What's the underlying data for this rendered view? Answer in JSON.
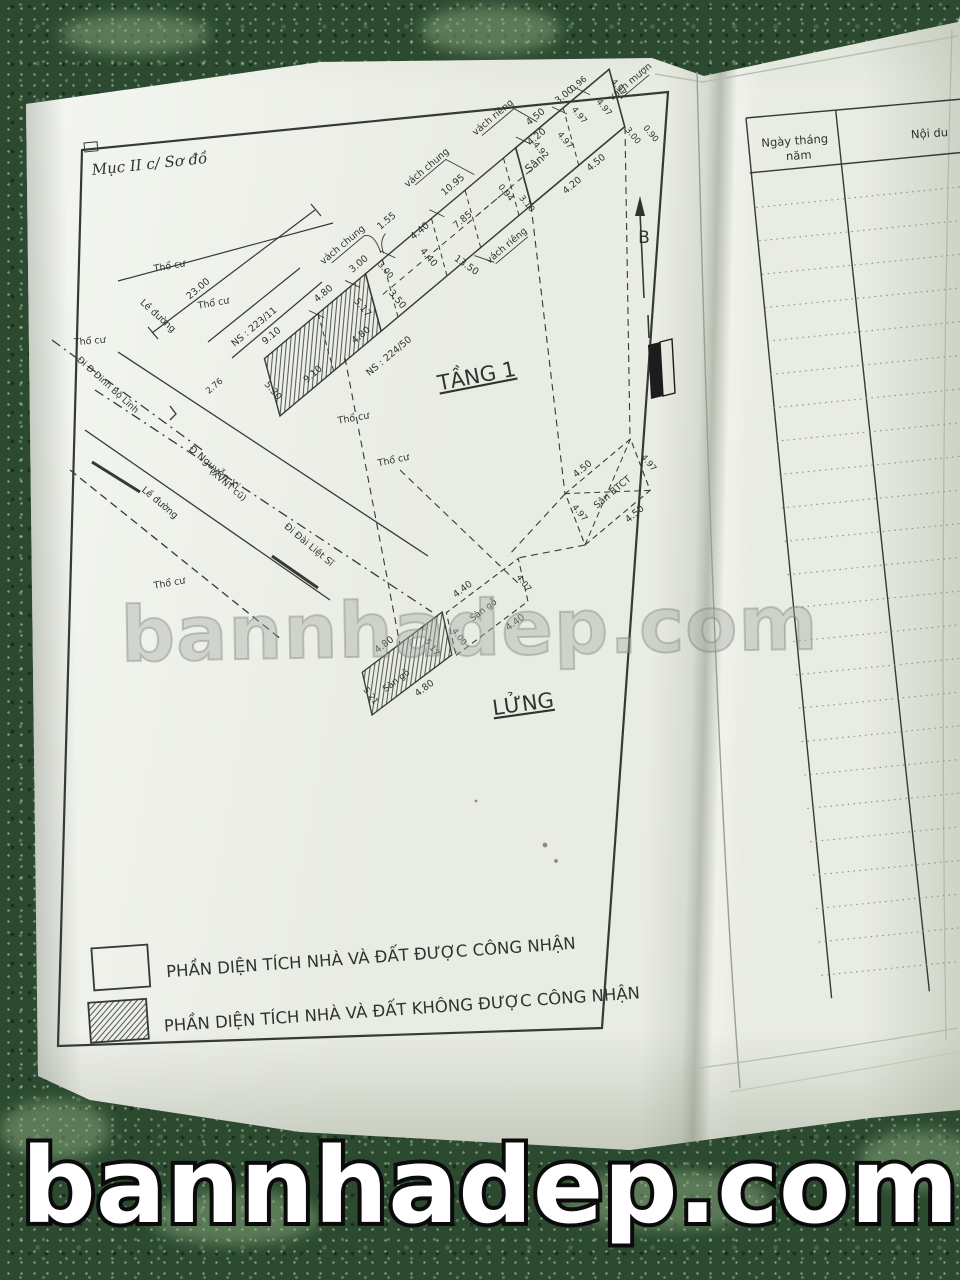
{
  "page_title": "Mục II c/ Sơ đồ",
  "watermark": {
    "middle": "bannhadep.com",
    "bottom": "bannhadep.com"
  },
  "legend": {
    "items": [
      {
        "swatch": "plain",
        "label": "PHẦN DIỆN TÍCH NHÀ VÀ ĐẤT ĐƯỢC CÔNG NHẬN"
      },
      {
        "swatch": "hatched",
        "label": "PHẦN DIỆN TÍCH NHÀ VÀ ĐẤT KHÔNG ĐƯỢC CÔNG NHẬN"
      }
    ]
  },
  "right_page": {
    "header": {
      "col1_lines": [
        "Ngày tháng",
        "năm"
      ],
      "col2": "Nội du"
    },
    "rows": 24
  },
  "colors": {
    "paper": "#e9ece3",
    "floor": "#2b4a30",
    "ink": "#343a34"
  },
  "plan": {
    "floor1_name": "TẦNG 1",
    "mezzanine_name": "LỬNG",
    "north_label": "B",
    "labels": [
      {
        "t": "TẦNG 1",
        "x": 478,
        "y": 383,
        "r": -11,
        "s": 21,
        "u": 1,
        "n": "floor-1-label"
      },
      {
        "t": "LỬNG",
        "x": 524,
        "y": 711,
        "r": -8,
        "s": 21,
        "u": 1,
        "n": "mezzanine-label"
      },
      {
        "t": "23.00",
        "x": 200,
        "y": 291,
        "r": -40,
        "n": "dim-23-00"
      },
      {
        "t": "NS : 223/11",
        "x": 256,
        "y": 329,
        "r": -40,
        "n": "house-number-223-11"
      },
      {
        "t": "2.76",
        "x": 216,
        "y": 388,
        "r": -40,
        "s": 8.5
      },
      {
        "t": "Thổ cư",
        "x": 170,
        "y": 269,
        "r": -10,
        "n": "tho-cu-label"
      },
      {
        "t": "Thổ cư",
        "x": 214,
        "y": 306,
        "r": -10,
        "n": "tho-cu-label"
      },
      {
        "t": "Thổ cư",
        "x": 90,
        "y": 344,
        "r": -5,
        "n": "tho-cu-label"
      },
      {
        "t": "Thổ cư",
        "x": 170,
        "y": 586,
        "r": -10,
        "n": "tho-cu-label"
      },
      {
        "t": "Thổ cư",
        "x": 354,
        "y": 421,
        "r": -10,
        "n": "tho-cu-label"
      },
      {
        "t": "Thổ cư",
        "x": 394,
        "y": 463,
        "r": -12,
        "n": "tho-cu-label"
      },
      {
        "t": "Lề đường",
        "x": 156,
        "y": 318,
        "r": 42,
        "n": "sidewalk-label"
      },
      {
        "t": "Lề đường",
        "x": 158,
        "y": 505,
        "r": 40,
        "n": "sidewalk-label"
      },
      {
        "t": "Đi Đ Đinh Bộ Lĩnh",
        "x": 106,
        "y": 387,
        "r": 42,
        "s": 9,
        "n": "street-dinh-bo-linh"
      },
      {
        "t": "Đ Nguyễn Xí",
        "x": 212,
        "y": 470,
        "r": 40,
        "s": 10,
        "n": "street-nguyen-xi"
      },
      {
        "t": "(XVNT cũ)",
        "x": 226,
        "y": 487,
        "r": 40,
        "s": 9,
        "n": "street-nguyen-xi-old"
      },
      {
        "t": "Đi Đài Liệt Sĩ",
        "x": 307,
        "y": 547,
        "r": 40,
        "s": 9.5,
        "n": "street-dai-liet-si"
      },
      {
        "t": "B",
        "x": 644,
        "y": 243,
        "s": 17,
        "n": "north-label"
      },
      {
        "g": "strip",
        "t": "9.10",
        "x": 45,
        "y": -64
      },
      {
        "g": "strip",
        "t": "4.80",
        "x": 112,
        "y": -63
      },
      {
        "g": "strip",
        "t": "3.00",
        "x": 158,
        "y": -63
      },
      {
        "g": "strip",
        "t": "1.55",
        "x": 207,
        "y": -78
      },
      {
        "g": "strip",
        "t": "4.40",
        "x": 226,
        "y": -49
      },
      {
        "g": "strip",
        "t": "4.40",
        "x": 213,
        "y": -26,
        "r": 90
      },
      {
        "g": "strip",
        "t": "3.00",
        "x": 172,
        "y": -44,
        "r": 90,
        "s": 8.5
      },
      {
        "g": "strip",
        "t": "10.95",
        "x": 281,
        "y": -63
      },
      {
        "g": "strip",
        "t": "5.30",
        "x": 8,
        "y": -24,
        "r": 90
      },
      {
        "g": "strip",
        "t": "9.10",
        "x": 52,
        "y": -8
      },
      {
        "g": "strip",
        "t": "4.80",
        "x": 114,
        "y": -7
      },
      {
        "g": "strip",
        "t": "5.17",
        "x": 130,
        "y": -30,
        "r": 90
      },
      {
        "g": "strip",
        "t": "3.50",
        "x": 162,
        "y": -14,
        "r": 90
      },
      {
        "g": "strip",
        "t": "7.85",
        "x": 266,
        "y": -30
      },
      {
        "g": "strip",
        "t": "13.50",
        "x": 237,
        "y": 5,
        "r": 75
      },
      {
        "g": "strip",
        "t": "0.94",
        "x": 314,
        "y": -26,
        "r": 90,
        "s": 8.5
      },
      {
        "g": "strip",
        "t": "3.10",
        "x": 323,
        "y": -4,
        "r": 90,
        "s": 8.5
      },
      {
        "g": "strip",
        "t": "NS : 224/50",
        "x": 122,
        "y": 27,
        "n": "house-number-224-50"
      },
      {
        "g": "strip",
        "t": "vách chung",
        "x": 158,
        "y": -88,
        "n": "wall-label-chung"
      },
      {
        "g": "strip",
        "t": "vách chung",
        "x": 272,
        "y": -93,
        "n": "wall-label-chung"
      },
      {
        "g": "strip",
        "t": "vách riêng",
        "x": 355,
        "y": -89,
        "n": "wall-label-rieng"
      },
      {
        "g": "strip",
        "t": "vách riêng",
        "x": 283,
        "y": 18,
        "n": "wall-label-rieng"
      },
      {
        "g": "strip",
        "t": "vách mượn",
        "x": 483,
        "y": -28,
        "n": "wall-label-muon"
      },
      {
        "g": "strip",
        "t": "Sân",
        "x": 357,
        "y": -26,
        "s": 11,
        "n": "yard-label"
      },
      {
        "g": "strip",
        "t": "4.20",
        "x": 376,
        "y": -46
      },
      {
        "g": "strip",
        "t": "4.50",
        "x": 388,
        "y": -62
      },
      {
        "g": "strip",
        "t": "3.00",
        "x": 424,
        "y": -60
      },
      {
        "g": "strip",
        "t": "0.96",
        "x": 442,
        "y": -60,
        "s": 8.5
      },
      {
        "g": "strip",
        "t": "4.92",
        "x": 368,
        "y": -36,
        "r": 90,
        "s": 8.5
      },
      {
        "g": "strip",
        "t": "4.97",
        "x": 393,
        "y": -28,
        "r": 90,
        "s": 8.5
      },
      {
        "g": "strip",
        "t": "4.97",
        "x": 420,
        "y": -38,
        "r": 90,
        "s": 8.5
      },
      {
        "g": "strip",
        "t": "4.97",
        "x": 444,
        "y": -28,
        "r": 90,
        "s": 8.5
      },
      {
        "g": "strip",
        "t": "4.97",
        "x": 468,
        "y": -34,
        "r": 90,
        "s": 8.5
      },
      {
        "g": "strip",
        "t": "4.20",
        "x": 372,
        "y": 14
      },
      {
        "g": "strip",
        "t": "4.50",
        "x": 405,
        "y": 12
      },
      {
        "g": "strip",
        "t": "3.00",
        "x": 448,
        "y": 12,
        "r": 90,
        "s": 8.5
      },
      {
        "g": "strip",
        "t": "0.90",
        "x": 463,
        "y": 22,
        "r": 90,
        "s": 8.5
      },
      {
        "g": "mez",
        "t": "4.80",
        "x": 52,
        "y": -46
      },
      {
        "g": "mez",
        "t": "5.17",
        "x": 86,
        "y": -18,
        "r": 90,
        "s": 8.5
      },
      {
        "g": "mez",
        "t": "Sàn gỗ",
        "x": 40,
        "y": -10,
        "s": 9,
        "n": "wood-floor-label"
      },
      {
        "g": "mez",
        "t": "5.21",
        "x": 8,
        "y": -16,
        "r": 90,
        "s": 8.5
      },
      {
        "g": "mez",
        "t": "4.80",
        "x": 58,
        "y": 13
      },
      {
        "g": "mez",
        "t": "4.40",
        "x": 148,
        "y": -43
      },
      {
        "g": "mez",
        "t": "4.07",
        "x": 198,
        "y": -14,
        "r": 90,
        "s": 8.5
      },
      {
        "g": "mez",
        "t": "4.40",
        "x": 170,
        "y": 15
      },
      {
        "g": "mez",
        "t": "4.00",
        "x": 114,
        "y": -10,
        "r": 90,
        "s": 8.5
      },
      {
        "g": "mez",
        "t": "Sàn gỗ",
        "x": 152,
        "y": -14,
        "s": 9,
        "n": "wood-floor-label"
      },
      {
        "g": "sanbtct",
        "t": "Sân BTCT",
        "x": 55,
        "y": -20,
        "s": 9.5,
        "n": "btct-yard-label"
      },
      {
        "g": "sanbtct",
        "t": "4.50",
        "x": 47,
        "y": -57
      },
      {
        "g": "sanbtct",
        "t": "4.97",
        "x": 99,
        "y": -22,
        "r": 90,
        "s": 8.5
      },
      {
        "g": "sanbtct",
        "t": "4.97",
        "x": 14,
        "y": -28,
        "r": 90,
        "s": 8.5
      },
      {
        "g": "sanbtct",
        "t": "4.50",
        "x": 58,
        "y": 11
      }
    ]
  }
}
